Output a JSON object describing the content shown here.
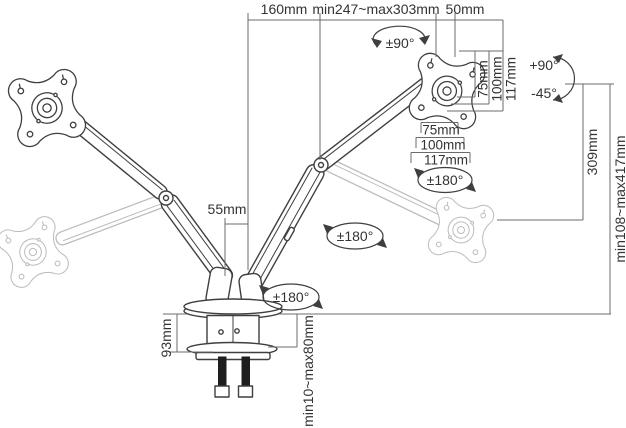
{
  "diagram": {
    "kind": "dual-monitor-desk-mount-dimension-drawing",
    "colors": {
      "line": "#3f3f3f",
      "dimension_line": "#6b6b6b",
      "ghost_line": "#bdbdbd",
      "text": "#333333",
      "bolt": "#1e1e1e",
      "background": "#ffffff"
    },
    "labels": {
      "reach_segment": "160mm",
      "reach_range": "min247~max303mm",
      "vesa_offset": "50mm",
      "arm_gap": "55mm",
      "drop": "309mm",
      "height_range": "min108~max417mm",
      "clamp_bracket_height": "93mm",
      "desk_thickness_range": "min10~max80mm"
    },
    "vesa": {
      "side": [
        "75mm",
        "100mm",
        "117mm"
      ],
      "bottom": [
        "75mm",
        "100mm",
        "117mm"
      ]
    },
    "rotation": {
      "swivel": "±90°",
      "pan": "±180°",
      "tilt_up": "+90°",
      "tilt_down": "-45°"
    }
  }
}
